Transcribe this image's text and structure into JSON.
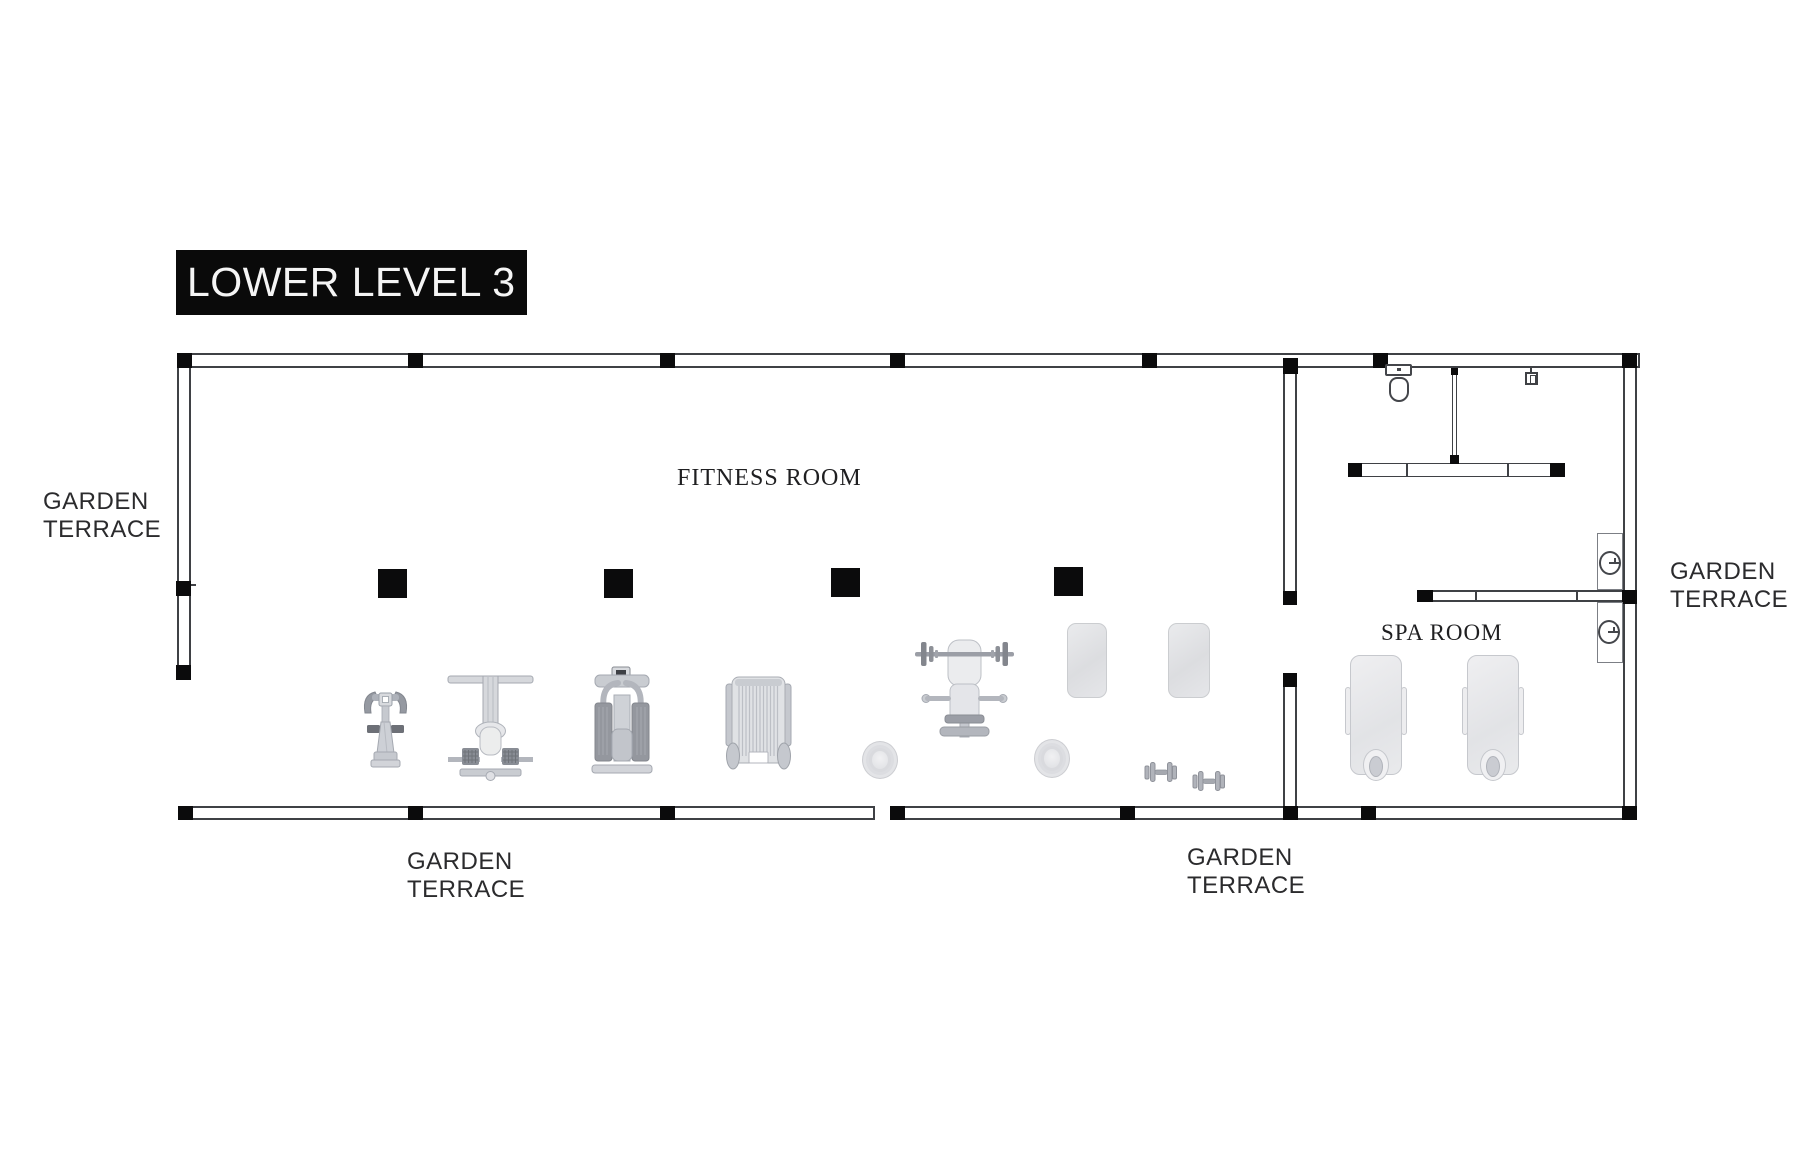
{
  "title": "LOWER LEVEL 3",
  "labels": {
    "fitness_room": "FITNESS ROOM",
    "spa_room": "SPA ROOM",
    "terrace_left": "GARDEN\nTERRACE",
    "terrace_right": "GARDEN\nTERRACE",
    "terrace_bottom_left": "GARDEN\nTERRACE",
    "terrace_bottom_right": "GARDEN\nTERRACE"
  },
  "colors": {
    "background": "#ffffff",
    "wall_outline": "#3f4145",
    "column_black": "#0b0b0c",
    "title_bg": "#0a0a0a",
    "title_text": "#f5f5f5",
    "room_label_text": "#1f1f21",
    "terrace_label_text": "#2b2b2d"
  },
  "icons": {
    "fitness_room_equipment": [
      "exercise-bike-icon",
      "weight-bench-machine-icon",
      "chest-press-machine-icon",
      "stair-climber-icon",
      "barbell-bench-icon",
      "exercise-mat-icon",
      "exercise-ball-icon",
      "dumbbell-icon"
    ],
    "spa_room_fixtures": [
      "massage-table-icon",
      "toilet-icon",
      "bench-counter",
      "wall-knob-icon"
    ]
  }
}
